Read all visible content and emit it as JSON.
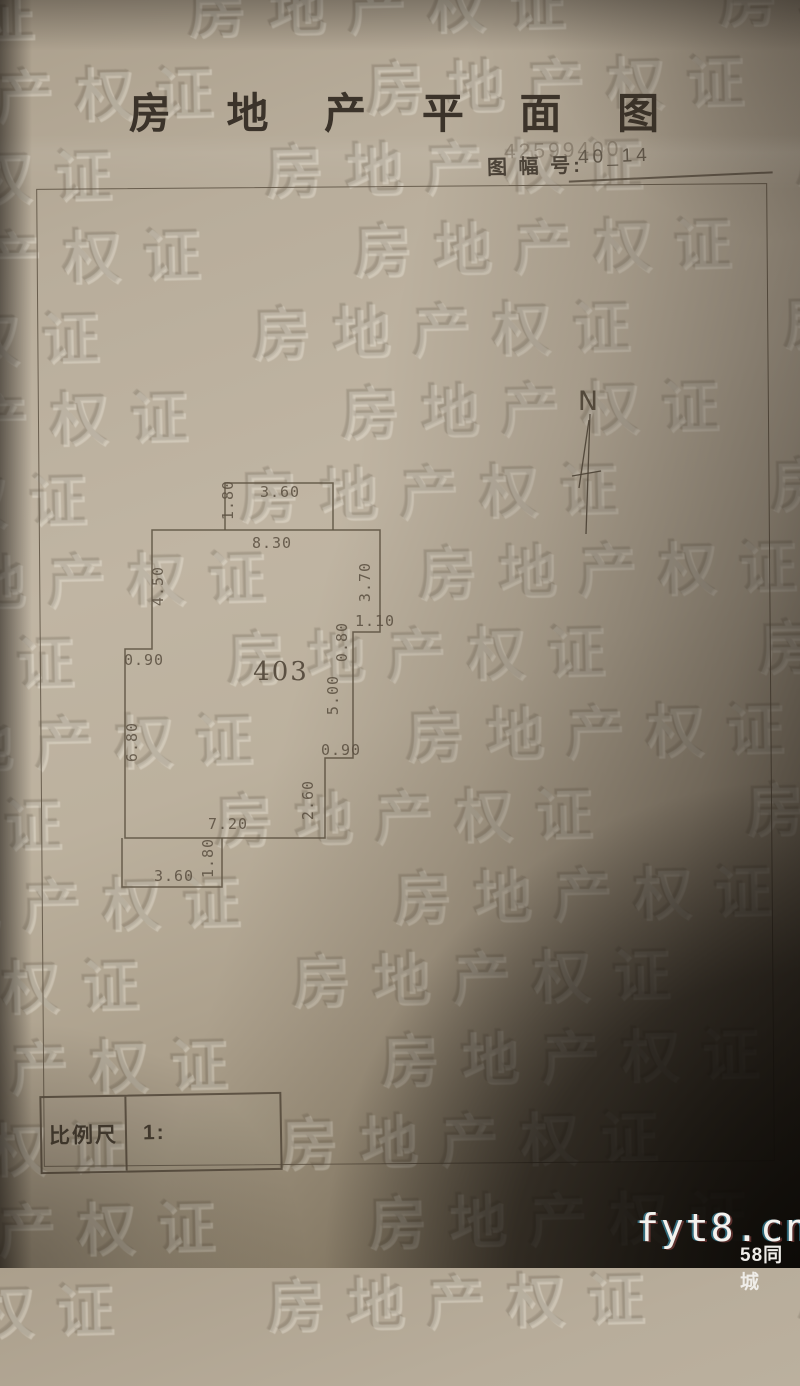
{
  "page": {
    "title": "房 地 产 平 面 图",
    "sheet_label": "图 幅 号:",
    "sheet_stamp": "42599400",
    "sheet_value": "40_14"
  },
  "north_arrow": {
    "label": "N"
  },
  "plan": {
    "room_number": "403",
    "dimensions": [
      {
        "text": "1.80",
        "x": 233,
        "y": 500,
        "rot": -90
      },
      {
        "text": "3.60",
        "x": 280,
        "y": 497,
        "rot": 0
      },
      {
        "text": "8.30",
        "x": 272,
        "y": 548,
        "rot": 0
      },
      {
        "text": "4.50",
        "x": 163,
        "y": 586,
        "rot": -90
      },
      {
        "text": "3.70",
        "x": 370,
        "y": 582,
        "rot": -90
      },
      {
        "text": "1.10",
        "x": 375,
        "y": 626,
        "rot": 0
      },
      {
        "text": "0.80",
        "x": 347,
        "y": 642,
        "rot": -90
      },
      {
        "text": "5.00",
        "x": 338,
        "y": 695,
        "rot": -90
      },
      {
        "text": "0.90",
        "x": 341,
        "y": 755,
        "rot": 0
      },
      {
        "text": "2.60",
        "x": 313,
        "y": 800,
        "rot": -90
      },
      {
        "text": "7.20",
        "x": 228,
        "y": 829,
        "rot": 0
      },
      {
        "text": "0.90",
        "x": 144,
        "y": 665,
        "rot": 0
      },
      {
        "text": "6.80",
        "x": 137,
        "y": 742,
        "rot": -90
      },
      {
        "text": "1.80",
        "x": 213,
        "y": 858,
        "rot": -90
      },
      {
        "text": "3.60",
        "x": 174,
        "y": 881,
        "rot": 0
      }
    ]
  },
  "scale_box": {
    "label": "比例尺",
    "value": "1:"
  },
  "watermark": {
    "text": "房地产权证"
  },
  "credits": {
    "site": "fyt8.cn",
    "brand": "58同城"
  },
  "colors": {
    "paper": "#bcb19e",
    "line": "#5f5444",
    "ink": "#3b332a",
    "shadow": "#0c0905"
  }
}
